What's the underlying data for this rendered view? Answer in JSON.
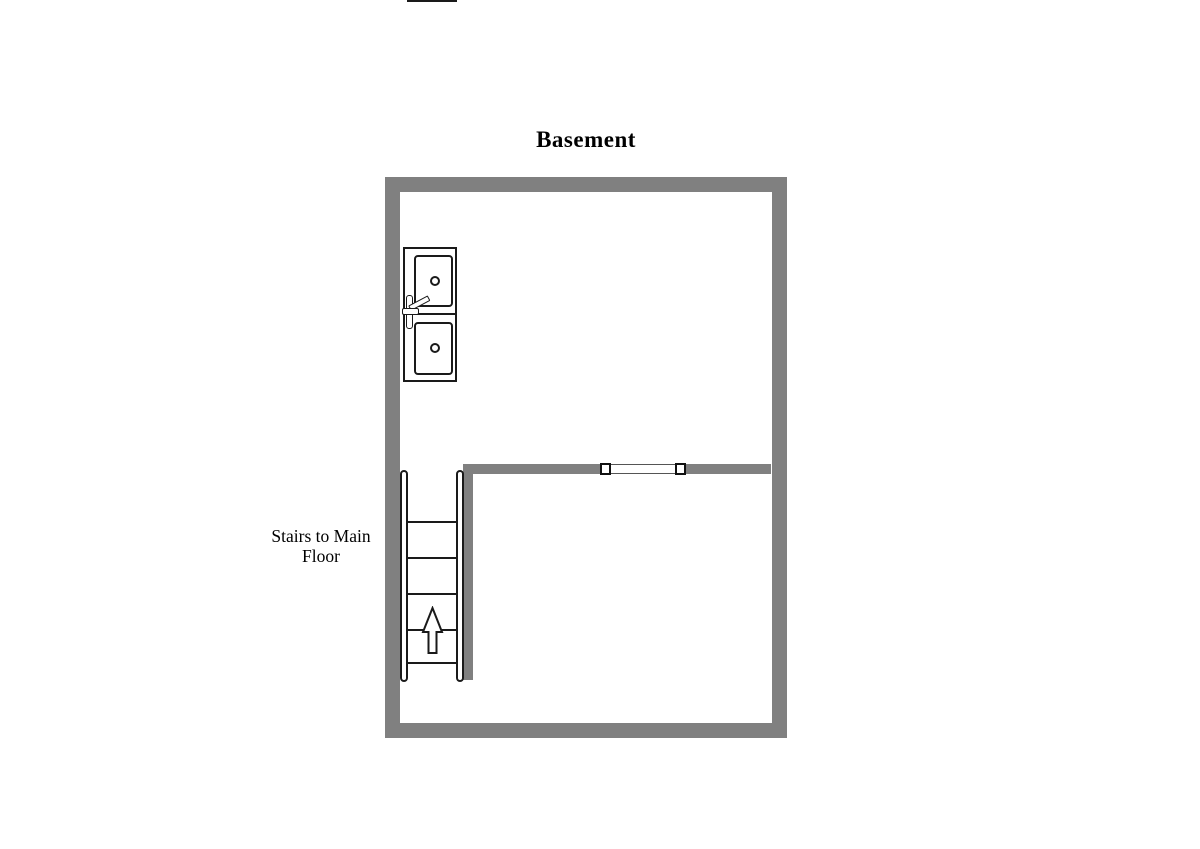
{
  "page": {
    "background": "#ffffff",
    "title": "Basement"
  },
  "colors": {
    "wall": "#808080",
    "outline": "#1a1a1a",
    "jamb": "#111111",
    "fill": "#ffffff"
  },
  "labels": {
    "title": "Basement",
    "stairs_line1": "Stairs to Main",
    "stairs_line2": "Floor"
  },
  "fixtures": {
    "double_sink": {
      "basin_count": 2,
      "drains": 2,
      "has_faucet": true
    },
    "stairs": {
      "tread_count": 6,
      "direction_arrow": "up"
    },
    "door_opening": {
      "type": "cased opening",
      "jambs": 2
    }
  }
}
